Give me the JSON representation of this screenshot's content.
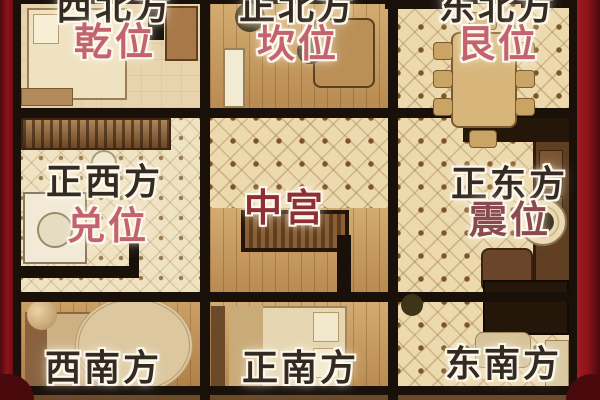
{
  "palaces": [
    {
      "direction": "西北方",
      "position": "乾位"
    },
    {
      "direction": "正北方",
      "position": "坎位"
    },
    {
      "direction": "东北方",
      "position": "艮位"
    },
    {
      "direction": "正西方",
      "position": "兑位"
    },
    {
      "direction": "中宫",
      "position": ""
    },
    {
      "direction": "正东方",
      "position": "震位"
    },
    {
      "direction": "西南方",
      "position": ""
    },
    {
      "direction": "正南方",
      "position": ""
    },
    {
      "direction": "东南方",
      "position": ""
    }
  ],
  "colors": {
    "side_bar": "#8c141a",
    "side_bar_dark": "#4a090d",
    "grid_line": "#19100a",
    "plan_base": "#e9d6aa",
    "direction_text": "#332a22",
    "position_text": "#c2636f",
    "center_text": "#8e2e36",
    "zhen_text": "#8a4b50"
  }
}
